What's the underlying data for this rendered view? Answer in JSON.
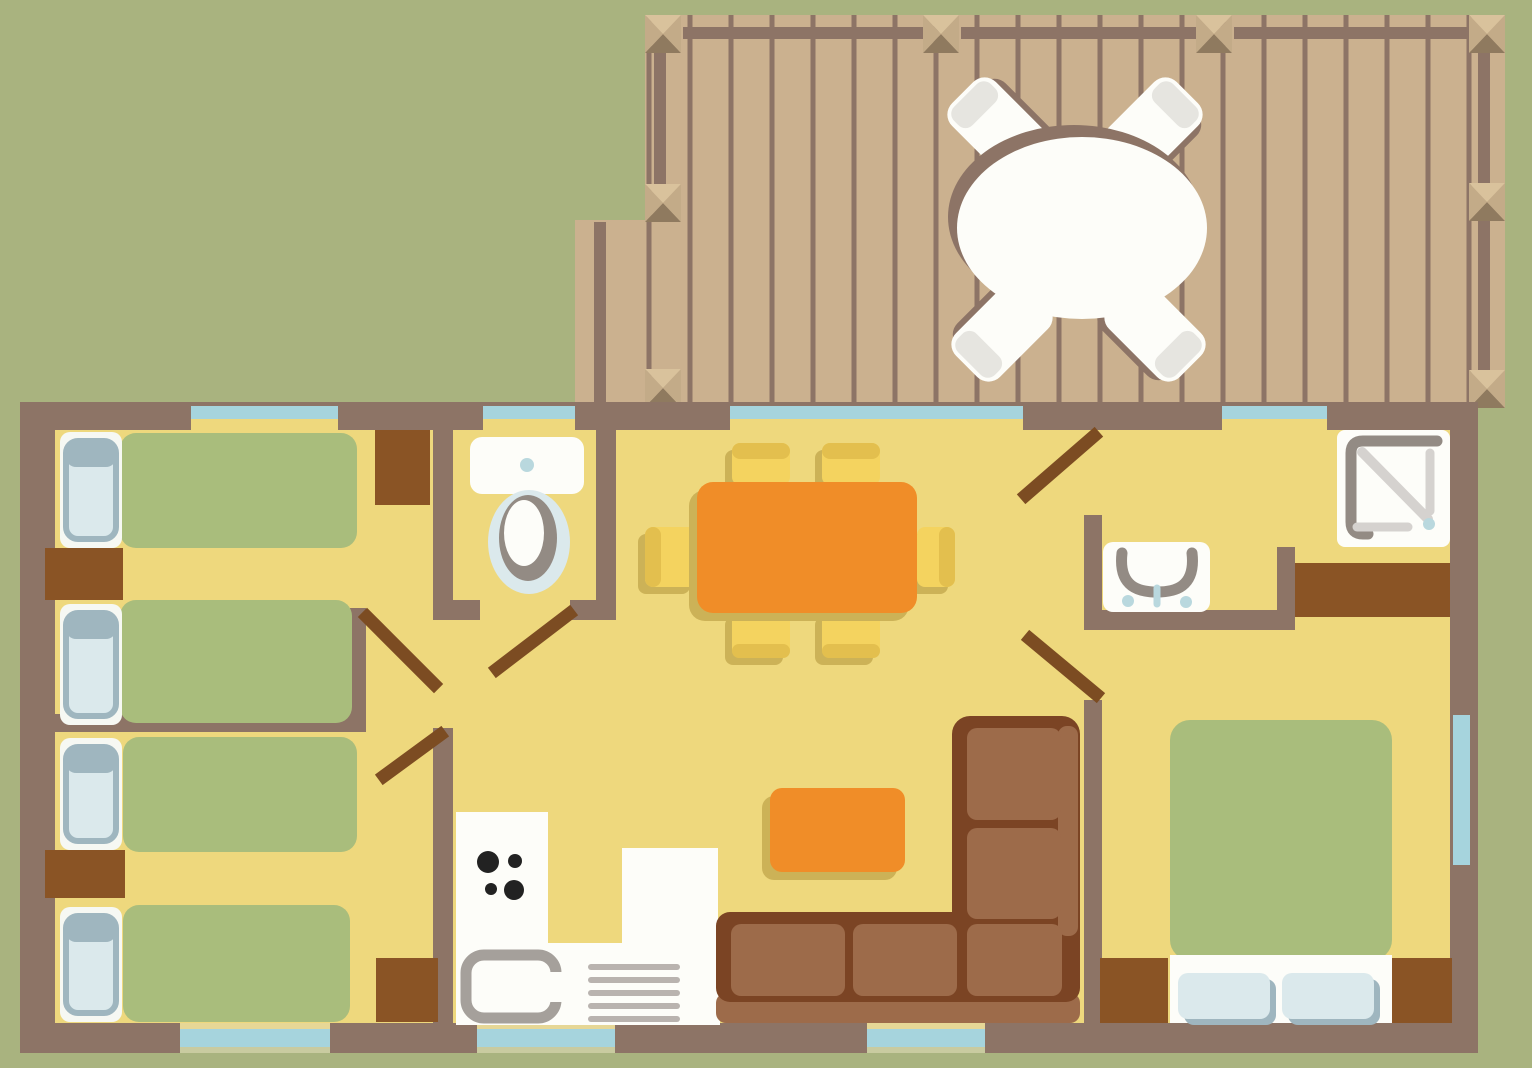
{
  "palette": {
    "background": "#a9b37f",
    "floor": "#eed87d",
    "wall": "#8d7466",
    "deck_plank": "#cbb18f",
    "deck_line": "#8d7466",
    "post_light": "#d9c29c",
    "post_dark": "#8f7a5f",
    "post_mid": "#c3ab88",
    "window_glass": "#a6d4dd",
    "window_sill": "#e6d796",
    "window_base": "#c9cba0",
    "furniture_brown": "#8a5425",
    "door_leaf": "#7c4c22",
    "bed_green": "#a9bd7c",
    "pillow_white": "#f6f8f3",
    "pillow_blue": "#dbe9ec",
    "pillow_edge": "#9fb6bf",
    "table_orange": "#f08d28",
    "shadow_olive": "#ccb257",
    "chair_yellow": "#f4d35f",
    "chair_band": "#e3bf4e",
    "sofa_dark": "#7b4424",
    "sofa_light": "#9d6b4a",
    "white": "#fdfdf9",
    "chair_white_band": "#e6e5e0",
    "fixture_gray": "#938b84",
    "light_gray": "#d5d2cf",
    "steel_gray": "#a5a09b",
    "slat_gray": "#b9b3af",
    "burner_black": "#222222",
    "water_blue": "#b9d8de"
  },
  "plan": {
    "rooms": [
      "deck-terrace",
      "twin-bedroom-top",
      "twin-bedroom-bottom",
      "wc",
      "living-dining",
      "kitchen",
      "shower-room",
      "master-bedroom"
    ],
    "icons": {
      "deck_table": "round-table-with-4-chairs",
      "single_bed": "single-bed-with-pillow",
      "double_bed": "double-bed-with-2-pillows",
      "toilet": "toilet-top-view",
      "shower": "shower-tray",
      "washbasin": "washbasin-with-faucet",
      "stove": "4-burner-hob",
      "kitchen_sink": "kitchen-sink",
      "dining_set": "rect-table-with-6-chairs",
      "sofa": "l-shaped-sofa",
      "coffee_table": "coffee-table",
      "wardrobe": "wardrobe-block",
      "door": "door-swing-leaf",
      "window": "window-glass-band"
    },
    "counts": {
      "single_beds": 4,
      "double_beds": 1,
      "dining_chairs": 6,
      "deck_chairs": 4,
      "doors": 5,
      "windows": 8
    }
  }
}
